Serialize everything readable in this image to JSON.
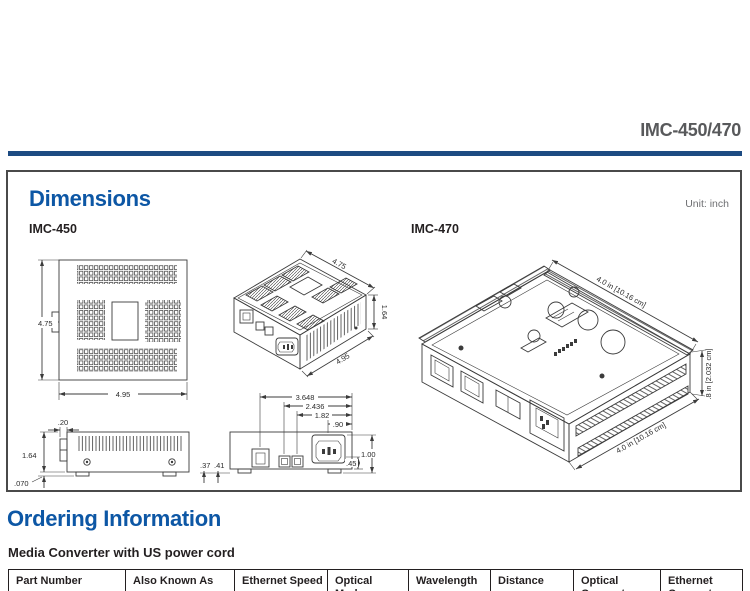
{
  "page": {
    "product_title": "IMC-450/470"
  },
  "dimensions": {
    "heading": "Dimensions",
    "unit_note": "Unit: inch",
    "model_left": "IMC-450",
    "model_right": "IMC-470",
    "imc450": {
      "top_view": {
        "height": "4.75",
        "width": "4.95"
      },
      "iso_view": {
        "depth": "4.75",
        "height": "1.64",
        "width": "4.95"
      },
      "side_view": {
        "tab_depth": ".20",
        "height": "1.64",
        "foot_height": ".070"
      },
      "front_view": {
        "rj45_offset": "3.648",
        "fiber1_offset": "2.436",
        "fiber2_offset": "1.82",
        "power_offset": ".90",
        "foot_inset": ".37",
        "foot_width": ".41",
        "power_height": ".45",
        "body_height": "1.00"
      }
    },
    "imc470": {
      "depth": "4.0 in [10.16 cm]",
      "height": ".8 in [2.032 cm]",
      "width": "4.0 in [10.16 cm]"
    }
  },
  "ordering": {
    "heading": "Ordering Information",
    "subheading": "Media Converter with US power cord",
    "table": {
      "columns": [
        "Part Number",
        "Also Known As",
        "Ethernet Speed",
        "Optical Mode",
        "Wavelength",
        "Distance",
        "Optical Connector",
        "Ethernet Connector"
      ]
    }
  },
  "colors": {
    "accent_blue": "#0d57a5",
    "rule_navy": "#1d4b82",
    "title_gray": "#58595b"
  }
}
